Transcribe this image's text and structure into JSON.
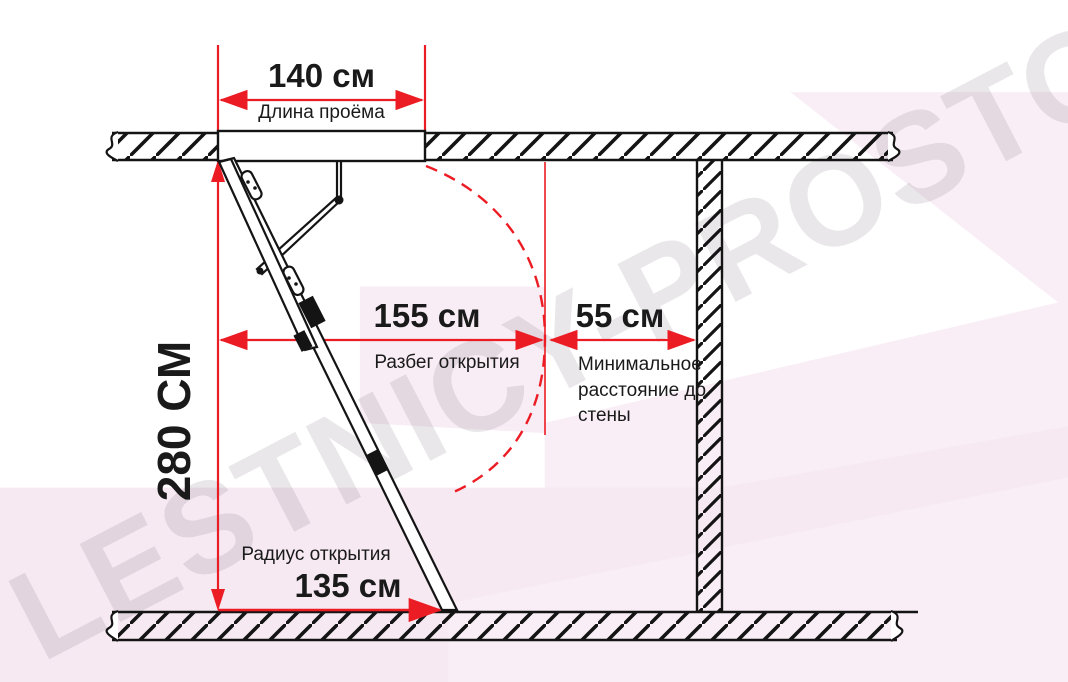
{
  "watermark": {
    "text": "LESTNICY-PROSTO.RU"
  },
  "dimensions": {
    "opening_length": {
      "value": "140 см",
      "label": "Длина проёма"
    },
    "ceiling_height": {
      "value": "280 СМ"
    },
    "opening_span": {
      "value": "155 см",
      "label": "Разбег открытия"
    },
    "min_wall_distance": {
      "value": "55 см",
      "label": "Минимальное расстояние до стены"
    },
    "opening_radius": {
      "value": "135 см",
      "label": "Радиус открытия"
    }
  },
  "colors": {
    "dimension_red": "#ec1c24",
    "outline_black": "#141414",
    "background_pink": "#f6e9f2",
    "watermark_gray": "#7d707d"
  }
}
